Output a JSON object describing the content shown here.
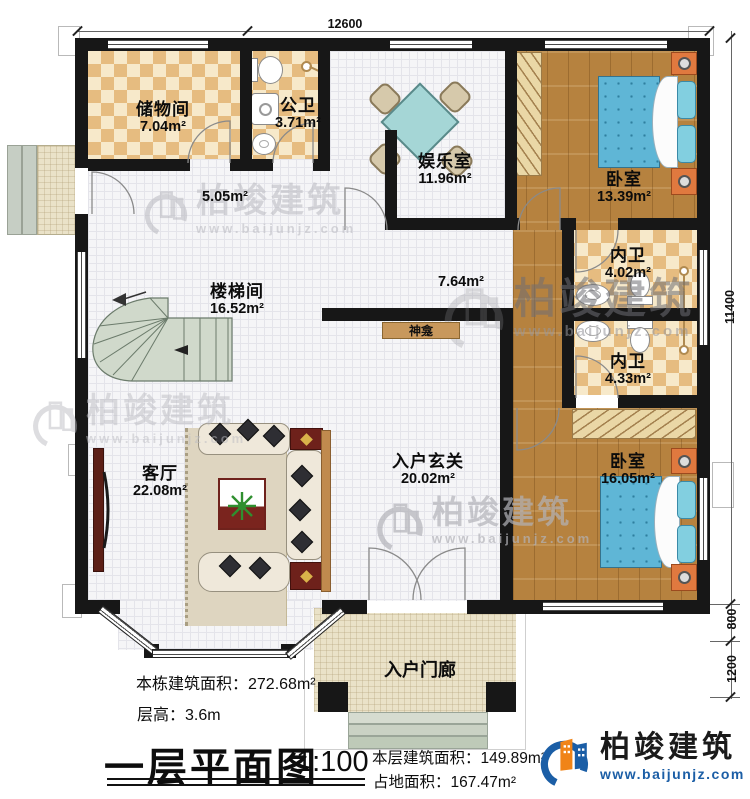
{
  "plan": {
    "dim_top": "12600",
    "dim_right_main": "11400",
    "dim_right_800": "800",
    "dim_right_1200": "1200",
    "rooms": [
      {
        "name": "储物间",
        "area": "7.04m²"
      },
      {
        "name": "公卫",
        "area": "3.71m²"
      },
      {
        "name": "娱乐室",
        "area": "11.96m²"
      },
      {
        "name": "卧室",
        "area": "13.39m²"
      },
      {
        "name": "内卫",
        "area": "4.02m²"
      },
      {
        "name": "内卫",
        "area": "4.33m²"
      },
      {
        "name": "楼梯间",
        "area": "16.52m²"
      },
      {
        "name": "客厅",
        "area": "22.08m²"
      },
      {
        "name": "入户玄关",
        "area": "20.02m²"
      },
      {
        "name": "卧室",
        "area": "16.05m²"
      }
    ],
    "free_labels": {
      "hall_area": "5.05m²",
      "corridor_area": "7.64m²",
      "shrine": "神龛",
      "entry_porch": "入户门廊"
    }
  },
  "footer": {
    "building_total_area": "本栋建筑面积：272.68m²",
    "floor_height": "层高：3.6m",
    "plan_title": "一层平面图",
    "scale": "1:100",
    "floor_area": "本层建筑面积：149.89m²",
    "footprint_area": "占地面积：167.47m²"
  },
  "logo": {
    "company": "柏竣建筑",
    "website": "www.baijunjz.com"
  },
  "watermark": {
    "company": "柏竣建筑",
    "website": "www.baijunjz.com"
  },
  "colors": {
    "wall": "#171717",
    "checker_tile": "#e6bc80",
    "wood_floor": "#b6823f",
    "bed_blue": "#5fb6d6",
    "stair_green": "#d0d9cb",
    "logo_blue": "#1b5ea6",
    "logo_orange": "#f08418"
  }
}
